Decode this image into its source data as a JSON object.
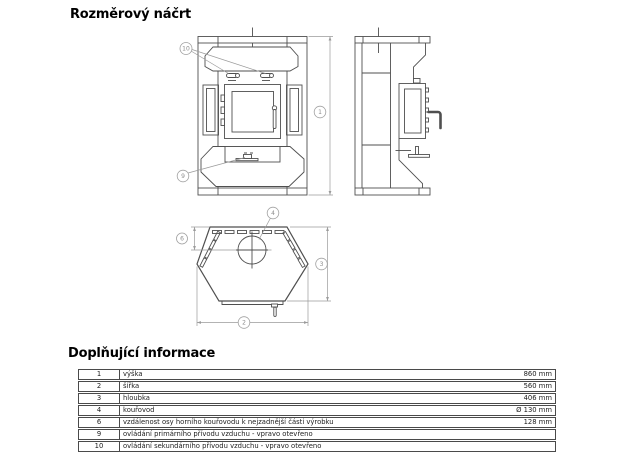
{
  "page": {
    "title": "Rozměrový náčrt",
    "section2_title": "Doplňující informace"
  },
  "drawing": {
    "callouts": {
      "c1": "1",
      "c2": "2",
      "c3": "3",
      "c4": "4",
      "c6": "6",
      "c9": "9",
      "c10": "10"
    }
  },
  "table": {
    "rows": [
      {
        "num": "1",
        "label": "výška",
        "value": "860 mm"
      },
      {
        "num": "2",
        "label": "šířka",
        "value": "560 mm"
      },
      {
        "num": "3",
        "label": "hloubka",
        "value": "406 mm"
      },
      {
        "num": "4",
        "label": "kouřovod",
        "value": "Ø 130 mm"
      },
      {
        "num": "6",
        "label": "vzdálenost osy horního kouřovodu k nejzadnější části výrobku",
        "value": "128 mm"
      },
      {
        "num": "9",
        "label": "ovládání primárního přívodu vzduchu - vpravo otevřeno",
        "value": ""
      },
      {
        "num": "10",
        "label": "ovládání sekundárního přívodu vzduchu - vpravo otevřeno",
        "value": ""
      }
    ]
  },
  "colors": {
    "line": "#4f4f4f",
    "dim": "#9a9a9a",
    "table_border": "#4a4a4a"
  }
}
